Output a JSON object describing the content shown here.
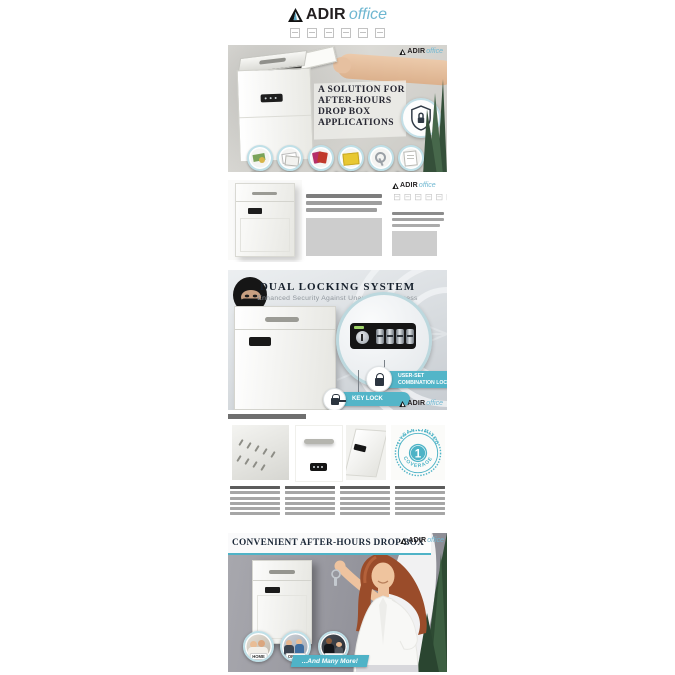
{
  "brand": {
    "name_bold": "ADIR",
    "name_light": "office"
  },
  "hero": {
    "headline_lines": [
      "A SOLUTION FOR",
      "AFTER-HOURS",
      "DROP BOX",
      "APPLICATIONS"
    ],
    "item_labels": [
      "Money",
      "Letters",
      "Cards",
      "Small Parcel",
      "Keys",
      "Documents"
    ]
  },
  "locking": {
    "title": "DUAL LOCKING SYSTEM",
    "subtitle": "Enhanced Security Against Unauthorized Access",
    "combo_callout_line1": "USER-SET",
    "combo_callout_line2": "COMBINATION LOCK",
    "key_callout": "KEY LOCK"
  },
  "warranty_badge": {
    "arc_top": "1 YEAR LIMITED",
    "center": "1",
    "arc_bottom": "COVERAGE"
  },
  "convenient": {
    "title": "CONVENIENT AFTER-HOURS DROP BOX",
    "location_labels": [
      "HOME",
      "OFFICE",
      "HOTEL"
    ],
    "more_text": "...And Many More!"
  },
  "colors": {
    "accent_teal": "#4FB3C7",
    "navy_text": "#1B2838",
    "logo_teal": "#6FB7D1",
    "bar_dark": "#5C5C5C",
    "bar_light": "#A6A6A6"
  }
}
